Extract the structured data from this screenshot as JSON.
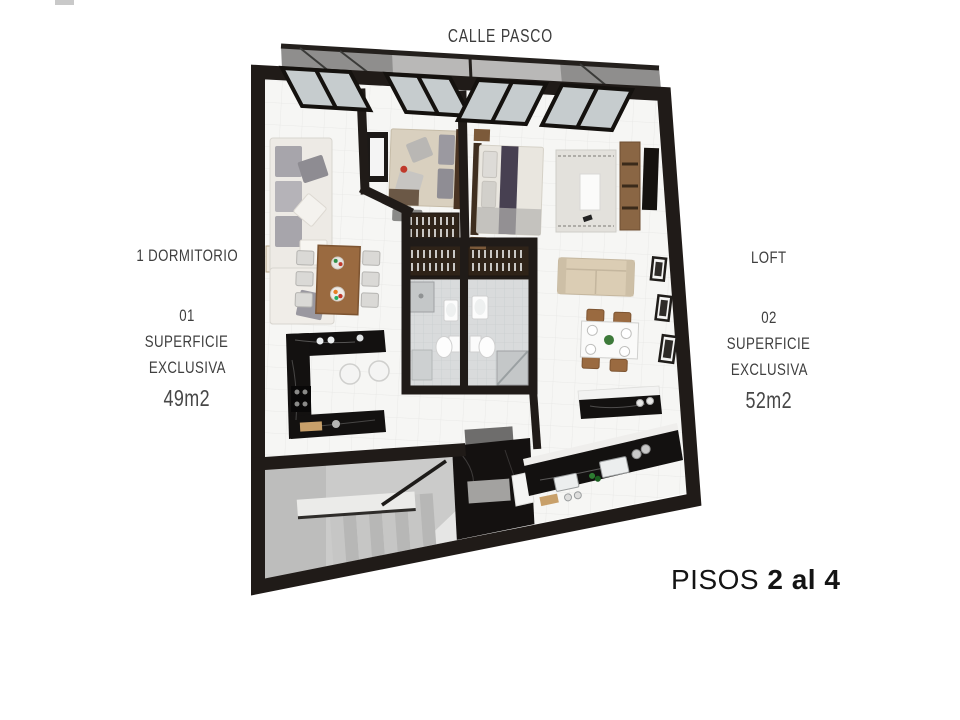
{
  "street_label": "CALLE PASCO",
  "unit_left": {
    "type": "1 DORMITORIO",
    "number": "01",
    "surface_line1": "SUPERFICIE",
    "surface_line2": "EXCLUSIVA",
    "area": "49m2"
  },
  "unit_right": {
    "type": "LOFT",
    "number": "02",
    "surface_line1": "SUPERFICIE",
    "surface_line2": "EXCLUSIVA",
    "area": "52m2"
  },
  "floors": {
    "prefix": "PISOS ",
    "range": "2 al 4"
  },
  "colors": {
    "wall": "#201b18",
    "floor": "#f6f6f4",
    "tile_line": "#e7e7e5",
    "concrete": "#c9c9c8",
    "bath_tile": "#d9dbdc",
    "marble": "#131110",
    "wood": "#96683e",
    "closet_wood": "#2f2318",
    "glass": "#c6ccce",
    "sofa_cream": "#edeae5",
    "bed_beige": "#d9d0bf",
    "label_text": "#3f3f3f"
  }
}
